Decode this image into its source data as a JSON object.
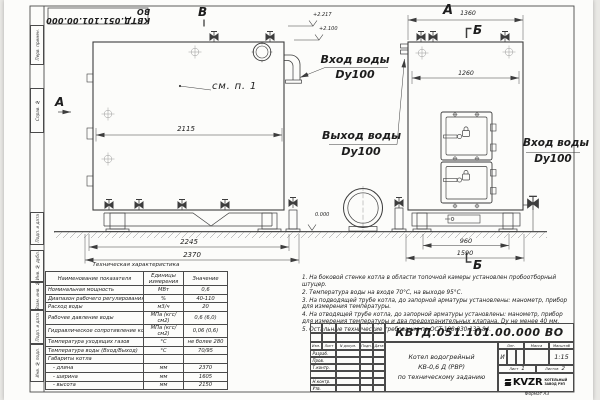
{
  "frame": {
    "stamp_top": "КВТД.051.101.00.000 ВО",
    "margin_labels": [
      "Перв. примен.",
      "Справ. №",
      "Подп. и дата",
      "Инв. № дубл.",
      "Взам. инв. №",
      "Подп. и дата",
      "Инв. № подл."
    ],
    "format_label": "Формат  А3"
  },
  "drawing": {
    "view_labels": {
      "front_top": "В",
      "front_left": "А",
      "side_top": "А",
      "section_top": "Б",
      "section_bottom": "Б"
    },
    "callout": "см. п. 1",
    "elevations": {
      "flue_top": "+2.217",
      "boiler_top": "+2.100",
      "ground": "0.000"
    },
    "dims": {
      "front_inner": "2115",
      "front_base": "2245",
      "front_total": "2370",
      "side_top": "1360",
      "side_inner": "1260",
      "side_base": "960",
      "side_total": "1590"
    },
    "labels": {
      "inlet_top": {
        "line1": "Вход воды",
        "line2": "Dy100"
      },
      "outlet": {
        "line1": "Выход воды",
        "line2": "Dy100"
      },
      "inlet_side": {
        "line1": "Вход воды",
        "line2": "Dy100"
      }
    }
  },
  "tech_table": {
    "title": "Техническая характеристика",
    "headers": [
      "Наименование показателя",
      "Единицы измерения",
      "Значение"
    ],
    "rows": [
      {
        "name": "Номинальная мощность",
        "unit": "МВт",
        "value": "0,6"
      },
      {
        "name": "Диапазон рабочего регулирования",
        "unit": "%",
        "value": "40-110"
      },
      {
        "name": "Расход воды",
        "unit": "м3/ч",
        "value": "20"
      },
      {
        "name": "Рабочее давление воды",
        "unit": "МПа (кгс/см2)",
        "value": "0,6 (6,0)"
      },
      {
        "name": "Гидравлическое сопротивление котла",
        "unit": "МПа (кгс/см2)",
        "value": "0,06 (0,6)"
      },
      {
        "name": "Температура уходящих газов",
        "unit": "°С",
        "value": "не более 280"
      },
      {
        "name": "Температура воды (Вход/Выход)",
        "unit": "°С",
        "value": "70/95"
      },
      {
        "name": "Габариты котла",
        "unit": "",
        "value": ""
      },
      {
        "name": "   - длина",
        "unit": "мм",
        "value": "2370"
      },
      {
        "name": "   - ширина",
        "unit": "мм",
        "value": "1605"
      },
      {
        "name": "   - высота",
        "unit": "мм",
        "value": "2150"
      }
    ]
  },
  "notes": [
    "1.  На боковой стенке котла в области топочной камеры установлен пробоотборный штуцер.",
    "2.  Температура воды на входе 70°С, на выходе 95°С.",
    "3.  На подводящей трубе котла, до запорной арматуры установлены: манометр, прибор для измерения температуры.",
    "4.  На отводящей трубе котла, до запорной арматуры установлены: манометр, прибор для измерения температуры и два предохранительных клапана. Dу не менее 40 мм.",
    "5.  Остальные технические требования по ОСТ 108.030.133-84."
  ],
  "title_block": {
    "designation": "КВТД.051.101.00.000  ВО",
    "rev_headers": [
      "Изм.",
      "Лист",
      "N докум.",
      "Подп.",
      "Дата"
    ],
    "row_labels": [
      "Разраб.",
      "Пров.",
      "Т.контр.",
      "",
      "Н.контр.",
      "Утв."
    ],
    "description": [
      "Котел водогрейный",
      "КВ-0,6 Д (РВР)",
      "по техническому заданию"
    ],
    "lit_header": [
      "Лит.",
      "Масса",
      "Масштаб"
    ],
    "lit_value": "И",
    "scale": "1:15",
    "sheet_label": "Лист",
    "sheet_no": "1",
    "sheets_label": "Листов",
    "sheets_no": "2",
    "logo_text": "KVZR",
    "logo_caption": [
      "КОТЕЛЬНЫЙ",
      "ЗАВОД РЭП"
    ]
  }
}
